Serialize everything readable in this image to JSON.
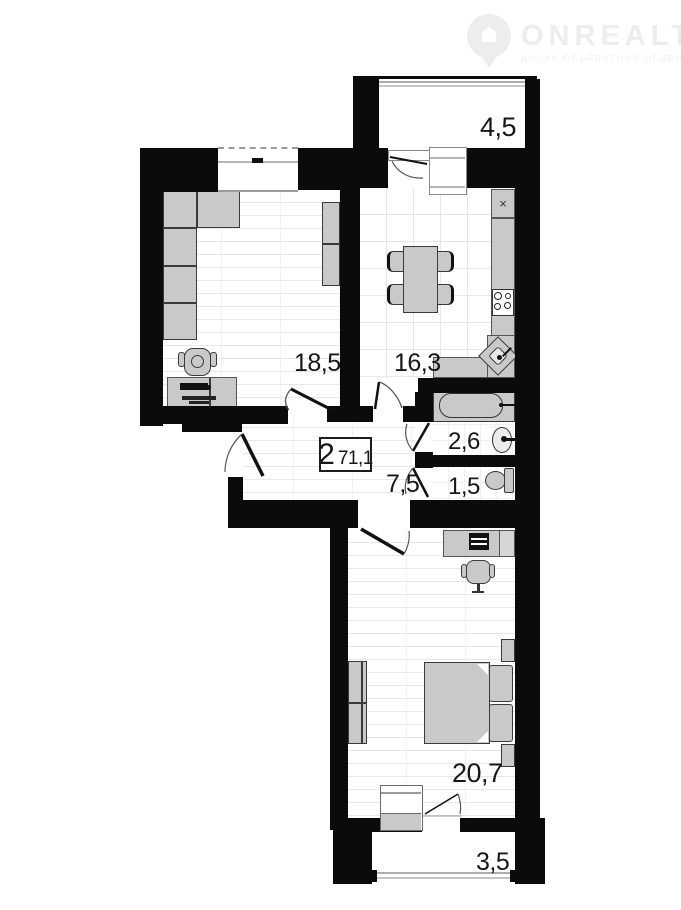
{
  "watermark": {
    "brand": "ONREALT",
    "tagline": "ДОСКА ОБЪЯВЛЕНИЙ НЕДВИЖИМОСТИ"
  },
  "plan": {
    "summary": {
      "rooms_count": "2",
      "total_area": "71,1"
    },
    "rooms": [
      {
        "id": "balcony-top",
        "area": "4,5"
      },
      {
        "id": "living-room",
        "area": "18,5"
      },
      {
        "id": "kitchen",
        "area": "16,3"
      },
      {
        "id": "bathroom",
        "area": "2,6"
      },
      {
        "id": "toilet",
        "area": "1,5"
      },
      {
        "id": "hallway",
        "area": "7,5"
      },
      {
        "id": "bedroom",
        "area": "20,7"
      },
      {
        "id": "balcony-bottom",
        "area": "3,5"
      }
    ]
  },
  "icons": {
    "x_mark": "×"
  },
  "colors": {
    "wall": "#0b0b0b",
    "furniture": "#c9c9c9",
    "outline": "#3a3a3a",
    "label_text": "#171717",
    "watermark": "#ededed"
  }
}
